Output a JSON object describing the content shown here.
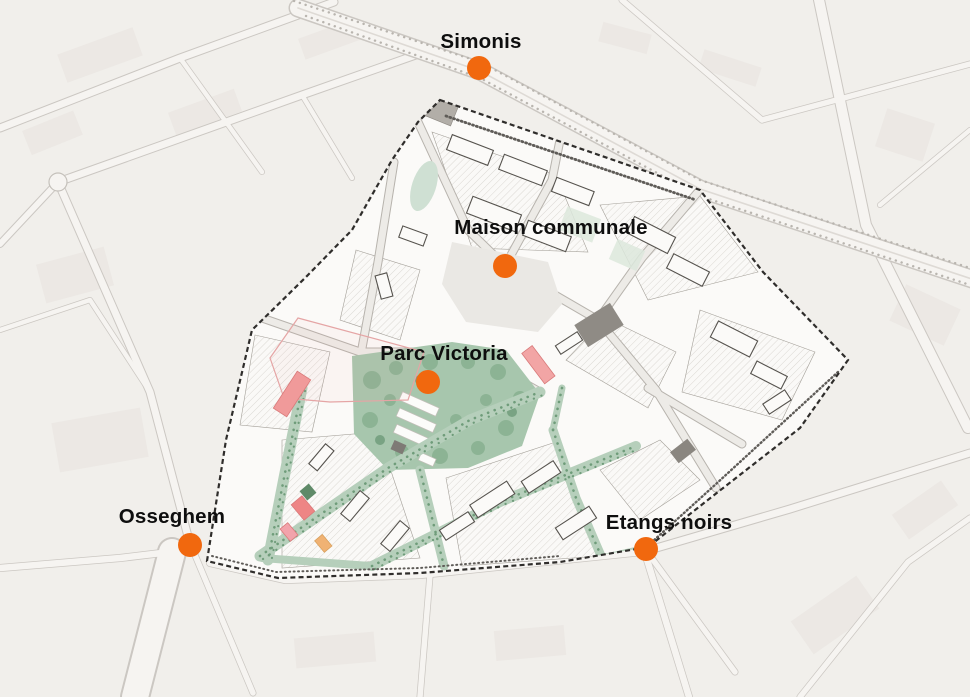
{
  "map": {
    "description": "Urban masterplan map of a neighbourhood with five labelled metro-station points",
    "colors": {
      "marker": "#f1680e",
      "label_text": "#0e0e0e",
      "background": "#f1efeb",
      "district_boundary": "#2f2d2b",
      "park_green": "#a7c6ad",
      "corridor_green": "#b6cfbb",
      "tree_green": "#6f9c7a",
      "highlight_red": "#f09a9a",
      "highlight_orange": "#f0b273",
      "gray_building": "#8f8b85"
    },
    "markers": [
      {
        "id": "simonis",
        "label": "Simonis",
        "dot": {
          "x": 479,
          "y": 68
        },
        "label_pos": {
          "x": 481,
          "y": 42
        }
      },
      {
        "id": "maison-communale",
        "label": "Maison communale",
        "dot": {
          "x": 505,
          "y": 266
        },
        "label_pos": {
          "x": 551,
          "y": 228
        }
      },
      {
        "id": "parc-victoria",
        "label": "Parc Victoria",
        "dot": {
          "x": 428,
          "y": 382
        },
        "label_pos": {
          "x": 444,
          "y": 354
        }
      },
      {
        "id": "osseghem",
        "label": "Osseghem",
        "dot": {
          "x": 190,
          "y": 545
        },
        "label_pos": {
          "x": 172,
          "y": 517
        }
      },
      {
        "id": "etangs-noirs",
        "label": "Etangs noirs",
        "dot": {
          "x": 646,
          "y": 549
        },
        "label_pos": {
          "x": 669,
          "y": 523
        }
      }
    ]
  }
}
